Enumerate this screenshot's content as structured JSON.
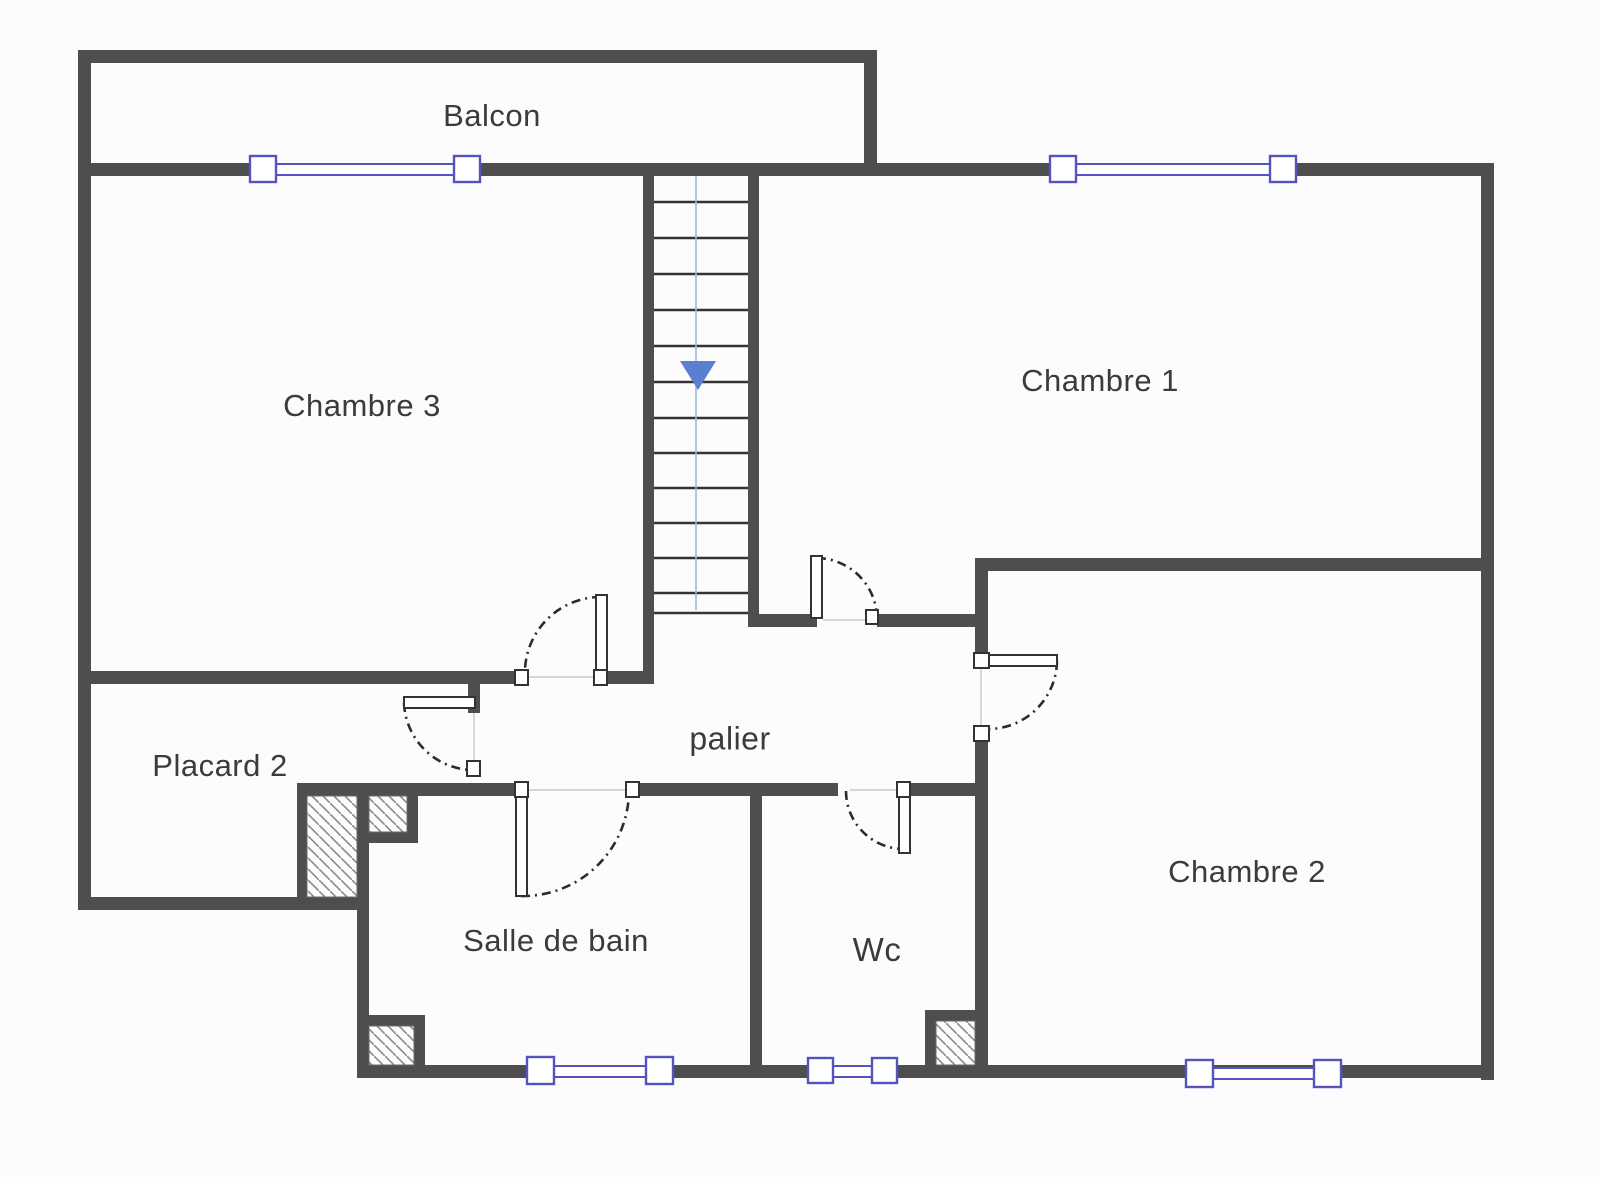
{
  "floor_plan": {
    "rooms": [
      {
        "id": "balcon",
        "label": "Balcon"
      },
      {
        "id": "chambre-3",
        "label": "Chambre 3"
      },
      {
        "id": "chambre-1",
        "label": "Chambre 1"
      },
      {
        "id": "chambre-2",
        "label": "Chambre 2"
      },
      {
        "id": "placard-2",
        "label": "Placard 2"
      },
      {
        "id": "palier",
        "label": "palier"
      },
      {
        "id": "salle-de-bain",
        "label": "Salle de bain"
      },
      {
        "id": "wc",
        "label": "Wc"
      }
    ],
    "stairs": {
      "direction": "down",
      "symbol": "down-arrow"
    },
    "colors": {
      "wall": "#4e4e4e",
      "window_frame": "#5454bc",
      "stair_arrow": "#5b7fd0",
      "stair_guide": "#9db4e0",
      "door_arc": "#2b2b2b",
      "hatch": "#8a8a8a",
      "label_text": "#3b3b3b",
      "background": "#fcfcfc"
    }
  }
}
